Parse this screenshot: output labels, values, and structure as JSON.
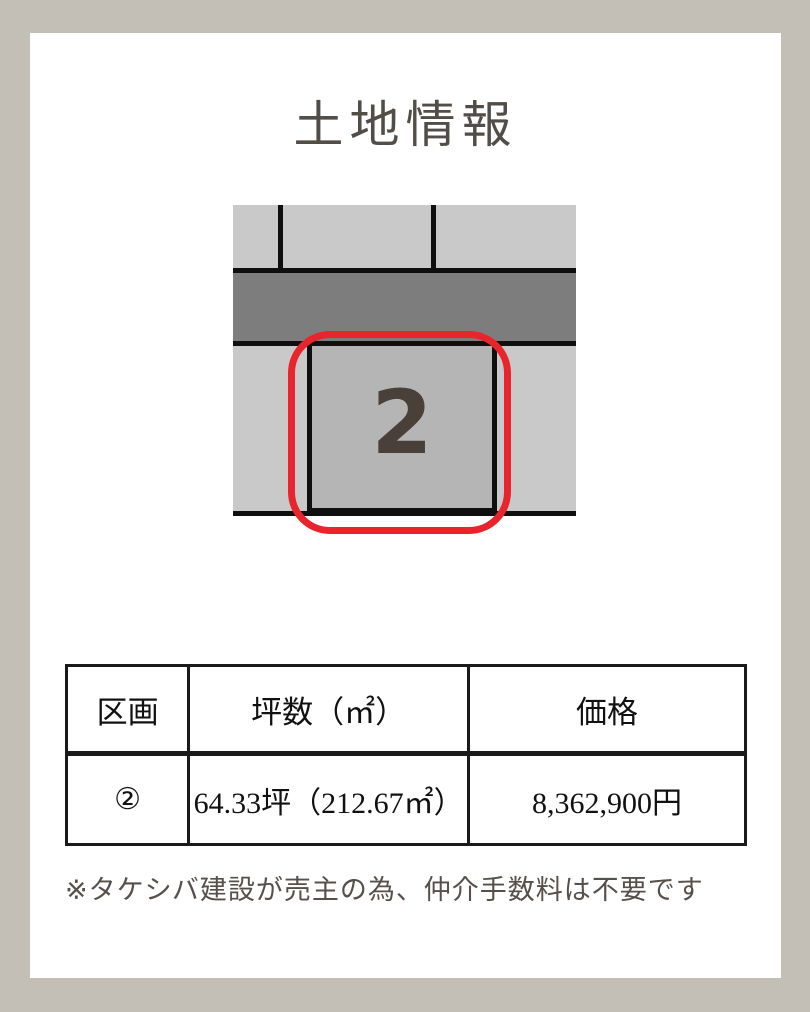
{
  "colors": {
    "page_background": "#c3beb6",
    "card_background": "#ffffff",
    "title_text": "#534d47",
    "table_text": "#111111",
    "table_border": "#1a1a1a",
    "note_text": "#57504a",
    "land_gray": "#c9c9c9",
    "road_gray": "#7d7d7d",
    "selected_plot_gray": "#b5b5b5",
    "diagram_line": "#0f0f0f",
    "highlight_red": "#e8242c",
    "plot_number_text": "#494039"
  },
  "title": "土地情報",
  "diagram": {
    "plot_number": "2"
  },
  "table": {
    "headers": [
      "区画",
      "坪数（㎡）",
      "価格"
    ],
    "row": {
      "section": "②",
      "area": "64.33坪（212.67㎡）",
      "price": "8,362,900円"
    }
  },
  "note": "※タケシバ建設が売主の為、仲介手数料は不要です"
}
